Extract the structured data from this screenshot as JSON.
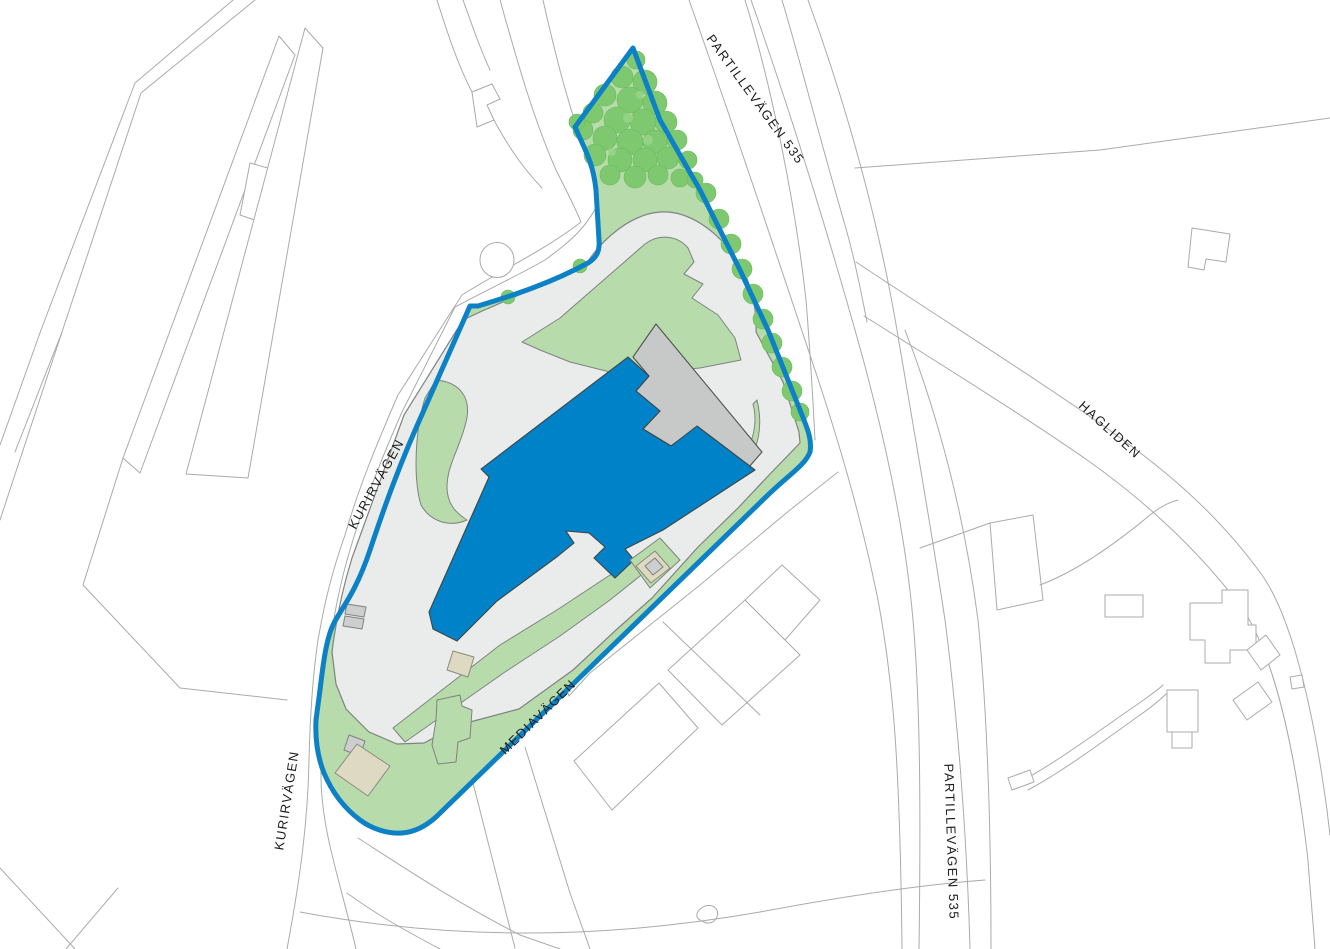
{
  "map": {
    "type": "site-plan",
    "description": "Property site plan with blue parcel boundary, main building and street names"
  },
  "labels": {
    "partillevagen_north": "PARTILLEVÄGEN  535",
    "partillevagen_south": "PARTILLEVÄGEN  535",
    "kurirvagen_north": "KURIRVÄGEN",
    "kurirvagen_south": "KURIRVÄGEN",
    "mediavagen": "MEDIAVÄGEN",
    "hagliden": "HAGLIDEN"
  },
  "colors": {
    "background": "#ffffff",
    "outline": "#a8aca9",
    "paved": "#eaeceb",
    "paved_outline": "#7e8381",
    "greenery": "#b7dbaa",
    "tree": "#7ec96f",
    "site_boundary": "#0d81c5",
    "building_primary": "#0082c8",
    "building_secondary": "#c7c9c8",
    "building_tan": "#ded9c3",
    "label": "#1c1c1c"
  }
}
